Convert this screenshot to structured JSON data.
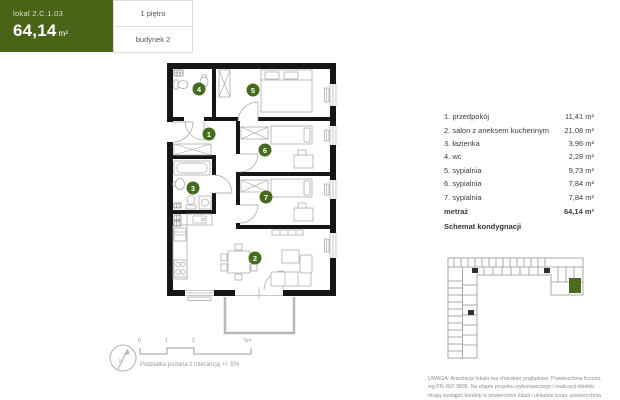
{
  "header": {
    "unit_prefix": "lokal",
    "unit_id": "2.C.1.03",
    "area_value": "64,14",
    "area_unit": "m²",
    "floor_label": "1 piętro",
    "building_label": "budynek 2",
    "accent_color": "#4a6417"
  },
  "room_list": {
    "rows": [
      {
        "label": "1. przedpokój",
        "area": "11,41 m²"
      },
      {
        "label": "2. salon z aneksem kuchennym",
        "area": "21,08 m²"
      },
      {
        "label": "3. łazienka",
        "area": "3,96 m²"
      },
      {
        "label": "4. wc",
        "area": "2,28 m²"
      },
      {
        "label": "5. sypialnia",
        "area": "9,73 m²"
      },
      {
        "label": "6. sypialnia",
        "area": "7,84 m²"
      },
      {
        "label": "7. sypialnia",
        "area": "7,84 m²"
      }
    ],
    "total_label": "metraż",
    "total_area": "64,14 m²",
    "schematic_title": "Schemat kondygnacji"
  },
  "plan": {
    "numbers": [
      "1",
      "2",
      "3",
      "4",
      "5",
      "6",
      "7"
    ],
    "number_color": "#456b1d"
  },
  "scale": {
    "tick0": "0",
    "tick1": "1",
    "tick2": "2",
    "tick5": "5m",
    "note": "Podziałka podana z tolerancją +/- 5%"
  },
  "compass": {
    "north_label": "N"
  },
  "disclaimer": {
    "line1": "UWAGA: Aranżacja lokalu ma charakter poglądowy. Powierzchnia liczona",
    "line2": "wg PN-ISO 9836. Na etapie projektu wykonawczego i realizacji obiektu",
    "line3": "mogą wystąpić korekty w powierzchni lokali i układzie ścian, powierzchnia"
  }
}
